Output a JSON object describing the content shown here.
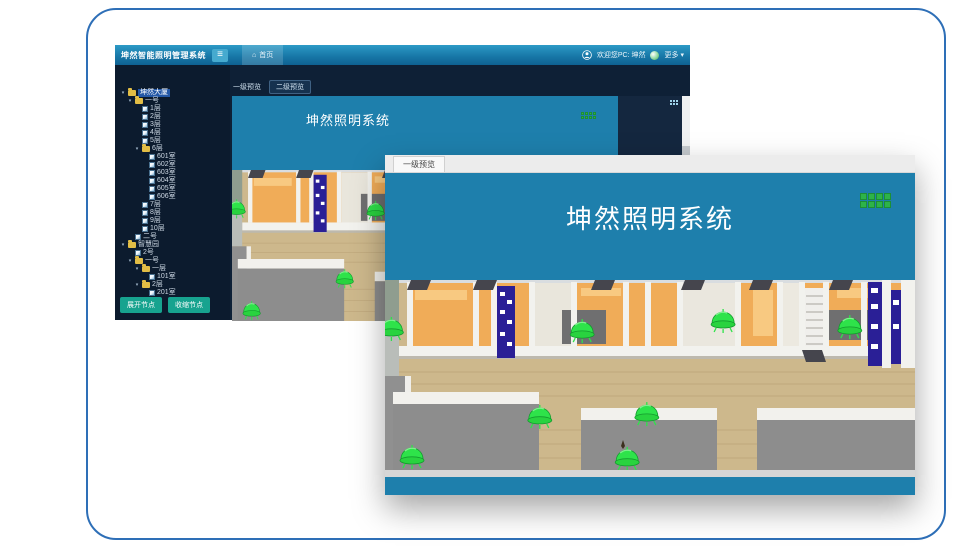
{
  "window": {
    "title": "坤然智能照明管理系统",
    "header": {
      "home_label": "首页",
      "welcome_text": "欢迎您PC: 坤然",
      "more_label": "更多"
    },
    "tabs": [
      {
        "label": "一级预览"
      },
      {
        "label": "二级预览"
      }
    ],
    "banner_title": "坤然照明系统",
    "tree_buttons": {
      "expand": "展开节点",
      "collapse": "收缩节点"
    }
  },
  "overlay": {
    "tab_label": "一级预览",
    "banner_title": "坤然照明系统"
  },
  "icons": {
    "menu": "≡",
    "home": "⌂",
    "more_caret": "▾"
  },
  "tree": [
    {
      "label": "坤然大厦",
      "type": "root",
      "selected": true,
      "children": [
        {
          "label": "一号",
          "type": "folder",
          "children": [
            {
              "label": "1层",
              "type": "leaf"
            },
            {
              "label": "2层",
              "type": "leaf"
            },
            {
              "label": "3层",
              "type": "leaf"
            },
            {
              "label": "4层",
              "type": "leaf"
            },
            {
              "label": "5层",
              "type": "leaf"
            },
            {
              "label": "6层",
              "type": "folder",
              "children": [
                {
                  "label": "601室",
                  "type": "leaf"
                },
                {
                  "label": "602室",
                  "type": "leaf"
                },
                {
                  "label": "603室",
                  "type": "leaf"
                },
                {
                  "label": "604室",
                  "type": "leaf"
                },
                {
                  "label": "605室",
                  "type": "leaf"
                },
                {
                  "label": "606室",
                  "type": "leaf"
                }
              ]
            },
            {
              "label": "7层",
              "type": "leaf"
            },
            {
              "label": "8层",
              "type": "leaf"
            },
            {
              "label": "9层",
              "type": "leaf"
            },
            {
              "label": "10层",
              "type": "leaf"
            }
          ]
        },
        {
          "label": "二号",
          "type": "leaf"
        }
      ]
    },
    {
      "label": "智慧园",
      "type": "folder",
      "children": [
        {
          "label": "2号",
          "type": "leaf"
        },
        {
          "label": "一号",
          "type": "folder",
          "children": [
            {
              "label": "一层",
              "type": "folder",
              "children": [
                {
                  "label": "101室",
                  "type": "leaf"
                }
              ]
            },
            {
              "label": "2层",
              "type": "folder",
              "children": [
                {
                  "label": "201室",
                  "type": "leaf"
                }
              ]
            }
          ]
        }
      ]
    }
  ],
  "lamps": [
    {
      "x": 0.012,
      "y": 0.263
    },
    {
      "x": 0.372,
      "y": 0.274
    },
    {
      "x": 0.638,
      "y": 0.221
    },
    {
      "x": 0.877,
      "y": 0.253
    },
    {
      "x": 0.292,
      "y": 0.726
    },
    {
      "x": 0.494,
      "y": 0.711
    },
    {
      "x": 0.051,
      "y": 0.937
    },
    {
      "x": 0.457,
      "y": 0.947
    }
  ],
  "grid_icon": {
    "rows": 2,
    "cols": 4
  },
  "colors": {
    "frame_border": "#2e6fb7",
    "banner_teal": "#1e7fac",
    "button_teal": "#17a38f",
    "lamp_green": "#2ee34a",
    "lamp_green_dark": "#149a2e",
    "grid_green": "#2db34a",
    "grid_green_dark": "#1d8f35"
  }
}
